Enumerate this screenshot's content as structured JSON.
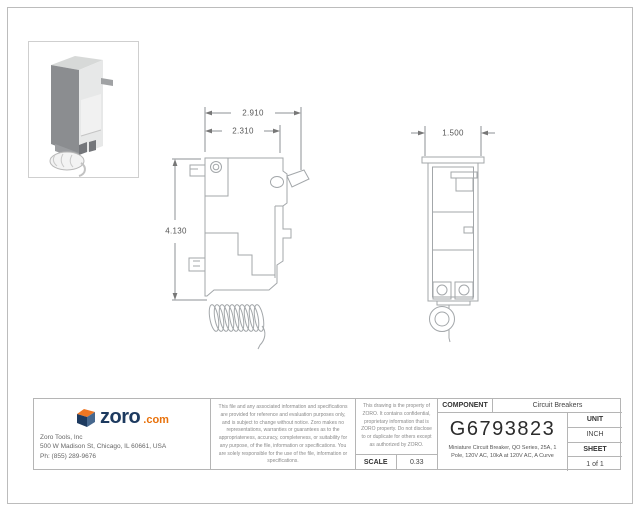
{
  "drawing": {
    "dimensions": {
      "overall_width": "2.910",
      "body_width": "2.310",
      "height": "4.130",
      "side_width": "1.500"
    }
  },
  "title_block": {
    "company": {
      "brand": "zoro",
      "brand_suffix": ".com",
      "name": "Zoro Tools, Inc",
      "address": "500 W Madison St, Chicago, IL 60661, USA",
      "phone": "Ph: (855) 289-9676"
    },
    "disclaimer": "This file and any associated information and specifications are provided for reference and evaluation purposes only, and is subject to change without notice. Zoro makes no representations, warranties or guarantees as to the appropriateness, accuracy, completeness, or suitability for any purpose, of the file, information or specifications. You are solely responsible for the use of the file, information or specifications.",
    "property_notice": "This drawing is the property of ZORO. It contains confidential, proprietary information that is ZORO property. Do not disclose to or duplicate for others except as authorized by ZORO.",
    "scale": {
      "label": "SCALE",
      "value": "0.33"
    },
    "component": {
      "label": "COMPONENT",
      "value": "Circuit Breakers"
    },
    "part_number": "G6793823",
    "description": "Miniature Circuit Breaker, QO Series, 25A, 1 Pole, 120V AC, 10kA at 120V AC, A Curve",
    "unit": {
      "label": "UNIT",
      "value": "INCH"
    },
    "sheet": {
      "label": "SHEET",
      "value": "1 of 1"
    }
  },
  "colors": {
    "brand_navy": "#1d3a5f",
    "brand_orange": "#e8720c",
    "line_gray": "#9aa0a4",
    "border_gray": "#b5b5b5"
  }
}
